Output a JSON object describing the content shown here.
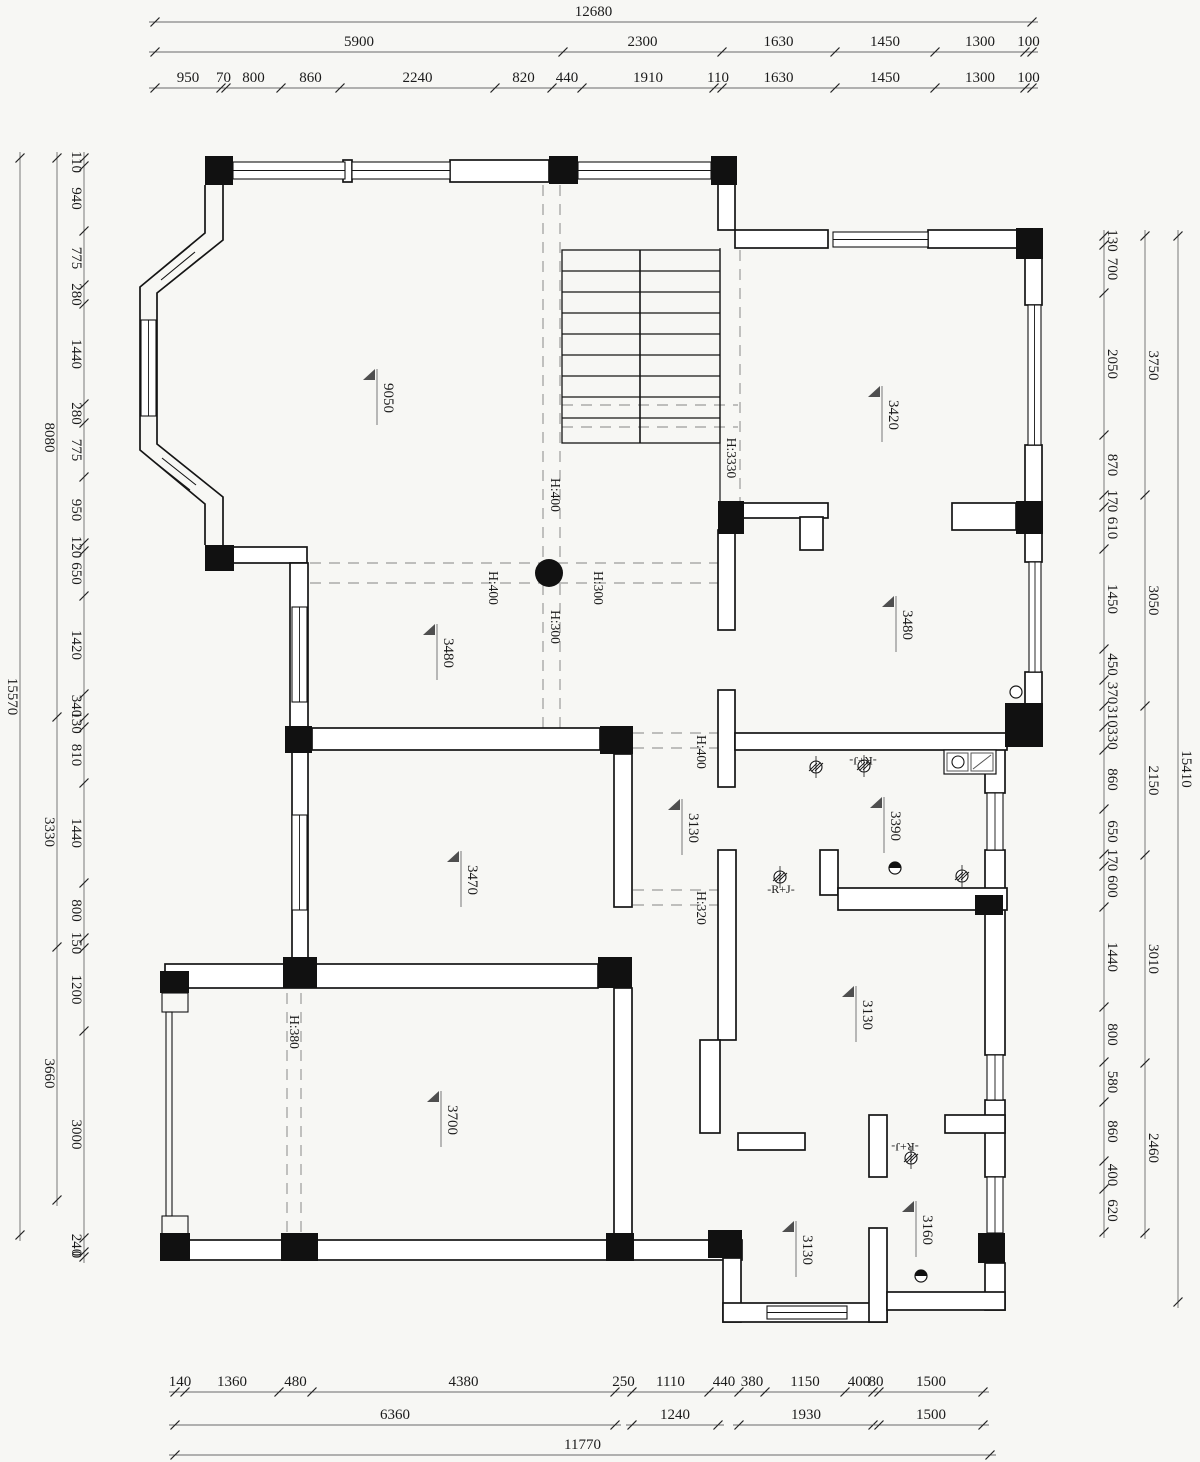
{
  "title": "floor-plan-drawing",
  "colors": {
    "background": "#f7f7f4",
    "ink": "#151515",
    "wall_fill": "#ffffff",
    "dim_line": "#6a6a6a",
    "dash": "#9b9b9b",
    "triangle": "#4f4f4f"
  },
  "plan": {
    "dim_chains": [
      {
        "dir": "h",
        "y": 22,
        "x0": 155,
        "tdy": -6,
        "segs": [
          [
            877,
            "12680"
          ]
        ]
      },
      {
        "dir": "h",
        "y": 52,
        "x0": 155,
        "tdy": -6,
        "segs": [
          [
            408,
            "5900"
          ],
          [
            159,
            "2300"
          ],
          [
            113,
            "1630"
          ],
          [
            100,
            "1450"
          ],
          [
            90,
            "1300"
          ],
          [
            7,
            "100"
          ]
        ]
      },
      {
        "dir": "h",
        "y": 88,
        "x0": 155,
        "tdy": -6,
        "segs": [
          [
            66,
            "950"
          ],
          [
            5,
            "70"
          ],
          [
            55,
            "800"
          ],
          [
            59,
            "860"
          ],
          [
            155,
            "2240"
          ],
          [
            57,
            "820"
          ],
          [
            30,
            "440"
          ],
          [
            132,
            "1910"
          ],
          [
            8,
            "110"
          ],
          [
            113,
            "1630"
          ],
          [
            100,
            "1450"
          ],
          [
            90,
            "1300"
          ],
          [
            7,
            "100"
          ]
        ]
      },
      {
        "dir": "v",
        "x": 20,
        "y0": 158,
        "tdx": -12,
        "segs": [
          [
            1077,
            "15570"
          ]
        ]
      },
      {
        "dir": "v",
        "x": 57,
        "y0": 158,
        "tdx": -12,
        "segs": [
          [
            559,
            "8080"
          ],
          [
            230,
            "3330"
          ],
          [
            253,
            "3660"
          ]
        ]
      },
      {
        "dir": "v",
        "x": 84,
        "y0": 158,
        "tdx": -12,
        "segs": [
          [
            8,
            "110"
          ],
          [
            65,
            "940"
          ],
          [
            54,
            "775"
          ],
          [
            19,
            "280"
          ],
          [
            100,
            "1440"
          ],
          [
            19,
            "280"
          ],
          [
            54,
            "775"
          ],
          [
            66,
            "950"
          ],
          [
            8,
            "120"
          ],
          [
            45,
            "650"
          ],
          [
            98,
            "1420"
          ],
          [
            24,
            "340"
          ],
          [
            9,
            "130"
          ],
          [
            56,
            "810"
          ],
          [
            100,
            "1440"
          ],
          [
            55,
            "800"
          ],
          [
            10,
            "150"
          ],
          [
            83,
            "1200"
          ],
          [
            207,
            "3000"
          ],
          [
            14,
            "240"
          ],
          [
            5,
            "0"
          ]
        ]
      },
      {
        "dir": "v",
        "x": 1178,
        "y0": 236,
        "tdx": 4,
        "segs": [
          [
            1066,
            "15410"
          ]
        ]
      },
      {
        "dir": "v",
        "x": 1145,
        "y0": 236,
        "tdx": 4,
        "segs": [
          [
            259,
            "3750"
          ],
          [
            211,
            "3050"
          ],
          [
            149,
            "2150"
          ],
          [
            208,
            "3010"
          ],
          [
            170,
            "2460"
          ]
        ]
      },
      {
        "dir": "v",
        "x": 1104,
        "y0": 236,
        "tdx": 4,
        "segs": [
          [
            9,
            "130"
          ],
          [
            48,
            "700"
          ],
          [
            142,
            "2050"
          ],
          [
            60,
            "870"
          ],
          [
            12,
            "170"
          ],
          [
            42,
            "610"
          ],
          [
            100,
            "1450"
          ],
          [
            31,
            "450"
          ],
          [
            26,
            "370"
          ],
          [
            21,
            "310"
          ],
          [
            23,
            "330"
          ],
          [
            59,
            "860"
          ],
          [
            45,
            "650"
          ],
          [
            12,
            "170"
          ],
          [
            41,
            "600"
          ],
          [
            100,
            "1440"
          ],
          [
            55,
            "800"
          ],
          [
            40,
            "580"
          ],
          [
            59,
            "860"
          ],
          [
            28,
            "400"
          ],
          [
            43,
            "620"
          ]
        ]
      },
      {
        "dir": "h",
        "y": 1392,
        "x0": 175,
        "tdy": -6,
        "segs": [
          [
            10,
            "140"
          ],
          [
            94,
            "1360"
          ],
          [
            33,
            "480"
          ],
          [
            303,
            "4380"
          ],
          [
            17,
            "250"
          ],
          [
            77,
            "1110"
          ],
          [
            30,
            "440"
          ],
          [
            26,
            "380"
          ],
          [
            80,
            "1150"
          ],
          [
            28,
            "400"
          ],
          [
            6,
            "80"
          ],
          [
            104,
            "1500"
          ]
        ]
      },
      {
        "dir": "h",
        "y": 1425,
        "x0": 175,
        "tdy": -6,
        "segs": [
          [
            440,
            "6360"
          ]
        ]
      },
      {
        "dir": "h",
        "y": 1425,
        "x0": 632,
        "tdy": -6,
        "segs": [
          [
            86,
            "1240"
          ]
        ]
      },
      {
        "dir": "h",
        "y": 1425,
        "x0": 739,
        "tdy": -6,
        "segs": [
          [
            134,
            "1930"
          ]
        ]
      },
      {
        "dir": "h",
        "y": 1425,
        "x0": 879,
        "tdy": -6,
        "segs": [
          [
            104,
            "1500"
          ]
        ]
      },
      {
        "dir": "h",
        "y": 1455,
        "x0": 175,
        "tdy": -6,
        "segs": [
          [
            815,
            "11770"
          ]
        ]
      }
    ],
    "walls": [
      [
        343,
        160,
        9,
        22
      ],
      [
        450,
        160,
        99,
        22
      ],
      [
        233,
        547,
        74,
        16
      ],
      [
        290,
        563,
        18,
        165
      ],
      [
        312,
        728,
        288,
        22
      ],
      [
        292,
        750,
        16,
        212
      ],
      [
        165,
        964,
        433,
        24
      ],
      [
        614,
        754,
        18,
        153
      ],
      [
        165,
        1240,
        577,
        20
      ],
      [
        614,
        988,
        18,
        252
      ],
      [
        723,
        1258,
        18,
        64
      ],
      [
        723,
        1303,
        164,
        19
      ],
      [
        869,
        1228,
        18,
        94
      ],
      [
        738,
        1133,
        67,
        17
      ],
      [
        869,
        1115,
        18,
        62
      ],
      [
        985,
        747,
        20,
        46
      ],
      [
        985,
        850,
        20,
        205
      ],
      [
        985,
        1100,
        20,
        77
      ],
      [
        985,
        1263,
        20,
        47
      ],
      [
        887,
        1292,
        118,
        18
      ],
      [
        945,
        1115,
        60,
        18
      ],
      [
        718,
        530,
        17,
        100
      ],
      [
        718,
        690,
        17,
        97
      ],
      [
        718,
        850,
        18,
        190
      ],
      [
        700,
        1040,
        20,
        93
      ],
      [
        735,
        733,
        272,
        17
      ],
      [
        820,
        850,
        18,
        45
      ],
      [
        838,
        888,
        169,
        22
      ],
      [
        718,
        183,
        17,
        47
      ],
      [
        735,
        230,
        93,
        18
      ],
      [
        928,
        230,
        90,
        18
      ],
      [
        1025,
        258,
        17,
        47
      ],
      [
        1025,
        445,
        17,
        58
      ],
      [
        1025,
        533,
        17,
        29
      ],
      [
        1025,
        672,
        17,
        33
      ],
      [
        743,
        503,
        85,
        15
      ],
      [
        800,
        517,
        23,
        33
      ],
      [
        952,
        503,
        64,
        27
      ]
    ],
    "windows": [
      [
        233,
        162,
        112,
        17
      ],
      [
        352,
        162,
        98,
        17
      ],
      [
        578,
        162,
        133,
        17
      ],
      [
        833,
        232,
        95,
        15
      ],
      [
        1028,
        305,
        13,
        140
      ],
      [
        1029,
        562,
        12,
        110
      ],
      [
        987,
        793,
        16,
        57
      ],
      [
        987,
        1055,
        16,
        45
      ],
      [
        987,
        1177,
        16,
        56
      ],
      [
        767,
        1306,
        80,
        13
      ],
      [
        292,
        607,
        15,
        95
      ],
      [
        292,
        815,
        15,
        95
      ],
      [
        141,
        320,
        15,
        96
      ]
    ],
    "columns": [
      [
        205,
        156,
        28,
        29
      ],
      [
        549,
        156,
        29,
        28
      ],
      [
        711,
        156,
        26,
        29
      ],
      [
        1016,
        228,
        27,
        31
      ],
      [
        1016,
        501,
        27,
        33
      ],
      [
        718,
        501,
        26,
        33
      ],
      [
        205,
        545,
        29,
        26
      ],
      [
        285,
        726,
        27,
        27
      ],
      [
        600,
        726,
        33,
        28
      ],
      [
        283,
        957,
        34,
        31
      ],
      [
        598,
        957,
        34,
        31
      ],
      [
        160,
        971,
        29,
        22
      ],
      [
        1005,
        703,
        38,
        44
      ],
      [
        975,
        895,
        28,
        20
      ],
      [
        160,
        1233,
        30,
        28
      ],
      [
        281,
        1233,
        37,
        28
      ],
      [
        606,
        1233,
        28,
        28
      ],
      [
        708,
        1230,
        34,
        28
      ],
      [
        978,
        1233,
        27,
        30
      ]
    ],
    "outline_squares": [
      [
        162,
        993,
        26,
        19
      ],
      [
        162,
        1216,
        26,
        18
      ],
      [
        166,
        1012,
        6,
        204
      ]
    ],
    "bay_paths": [
      "M205 185 L205 233 L140 287 L140 450 L205 504 L205 545",
      "M223 185 L223 240 L157 293 L157 444 L223 497 L223 545"
    ],
    "lines": [
      [
        156,
        274,
        190,
        246,
        1.1
      ],
      [
        161,
        280,
        195,
        252,
        1.1
      ],
      [
        166,
        286,
        200,
        258,
        1.1
      ],
      [
        156,
        463,
        190,
        490,
        1.1
      ],
      [
        162,
        458,
        196,
        485,
        1.1
      ],
      [
        168,
        453,
        202,
        480,
        1.1
      ],
      [
        720,
        248,
        720,
        501,
        1.2
      ]
    ],
    "dashed": [
      [
        543,
        185,
        543,
        728
      ],
      [
        560,
        185,
        560,
        728
      ],
      [
        310,
        563,
        718,
        563
      ],
      [
        310,
        583,
        718,
        583
      ],
      [
        287,
        993,
        287,
        1233
      ],
      [
        301,
        993,
        301,
        1233
      ],
      [
        633,
        733,
        720,
        733
      ],
      [
        633,
        748,
        720,
        748
      ],
      [
        633,
        890,
        720,
        890
      ],
      [
        633,
        905,
        720,
        905
      ],
      [
        562,
        405,
        738,
        405
      ],
      [
        562,
        427,
        738,
        427
      ],
      [
        740,
        250,
        740,
        501
      ]
    ],
    "stairs": {
      "x1": 562,
      "x2": 720,
      "top": 250,
      "bottom": 443,
      "divider": 640,
      "treads": [
        271,
        292,
        313,
        334,
        355,
        376,
        397,
        418
      ]
    },
    "fixtures": {
      "solid_circle": {
        "cx": 549,
        "cy": 573,
        "r": 14
      },
      "small_circles": [
        [
          1016,
          692,
          6
        ]
      ],
      "drain_circles": [
        [
          895,
          868,
          6
        ],
        [
          921,
          1276,
          6
        ]
      ],
      "hatch_circles": [
        [
          816,
          767
        ],
        [
          864,
          766
        ],
        [
          962,
          876
        ],
        [
          780,
          877
        ],
        [
          911,
          1158
        ]
      ],
      "counter": {
        "x": 944,
        "y": 750,
        "w": 52,
        "h": 24,
        "sink_cx": 958,
        "sink_cy": 762,
        "sink_r": 6
      }
    },
    "room_labels": [
      {
        "text": "9050",
        "x": 377,
        "y": 383
      },
      {
        "text": "3420",
        "x": 882,
        "y": 400
      },
      {
        "text": "3480",
        "x": 437,
        "y": 638
      },
      {
        "text": "3480",
        "x": 896,
        "y": 610
      },
      {
        "text": "3470",
        "x": 461,
        "y": 865
      },
      {
        "text": "3390",
        "x": 884,
        "y": 811
      },
      {
        "text": "3130",
        "x": 682,
        "y": 813
      },
      {
        "text": "3130",
        "x": 856,
        "y": 1000
      },
      {
        "text": "3700",
        "x": 441,
        "y": 1105
      },
      {
        "text": "3130",
        "x": 796,
        "y": 1235
      },
      {
        "text": "3160",
        "x": 916,
        "y": 1215
      }
    ],
    "beam_labels": [
      {
        "text": "H:400",
        "x": 551,
        "y": 495
      },
      {
        "text": "H:400",
        "x": 489,
        "y": 588
      },
      {
        "text": "H:300",
        "x": 594,
        "y": 588
      },
      {
        "text": "H:300",
        "x": 551,
        "y": 627
      },
      {
        "text": "H:3330",
        "x": 727,
        "y": 458
      },
      {
        "text": "H:400",
        "x": 697,
        "y": 752
      },
      {
        "text": "H:320",
        "x": 697,
        "y": 908
      },
      {
        "text": "H:380",
        "x": 290,
        "y": 1032
      }
    ],
    "rj_labels": [
      {
        "text": "-R+J-",
        "x": 863,
        "y": 757,
        "rot": 180
      },
      {
        "text": "-R+J-",
        "x": 781,
        "y": 893,
        "rot": 0
      },
      {
        "text": "-R+J-",
        "x": 905,
        "y": 1143,
        "rot": 180
      }
    ]
  }
}
